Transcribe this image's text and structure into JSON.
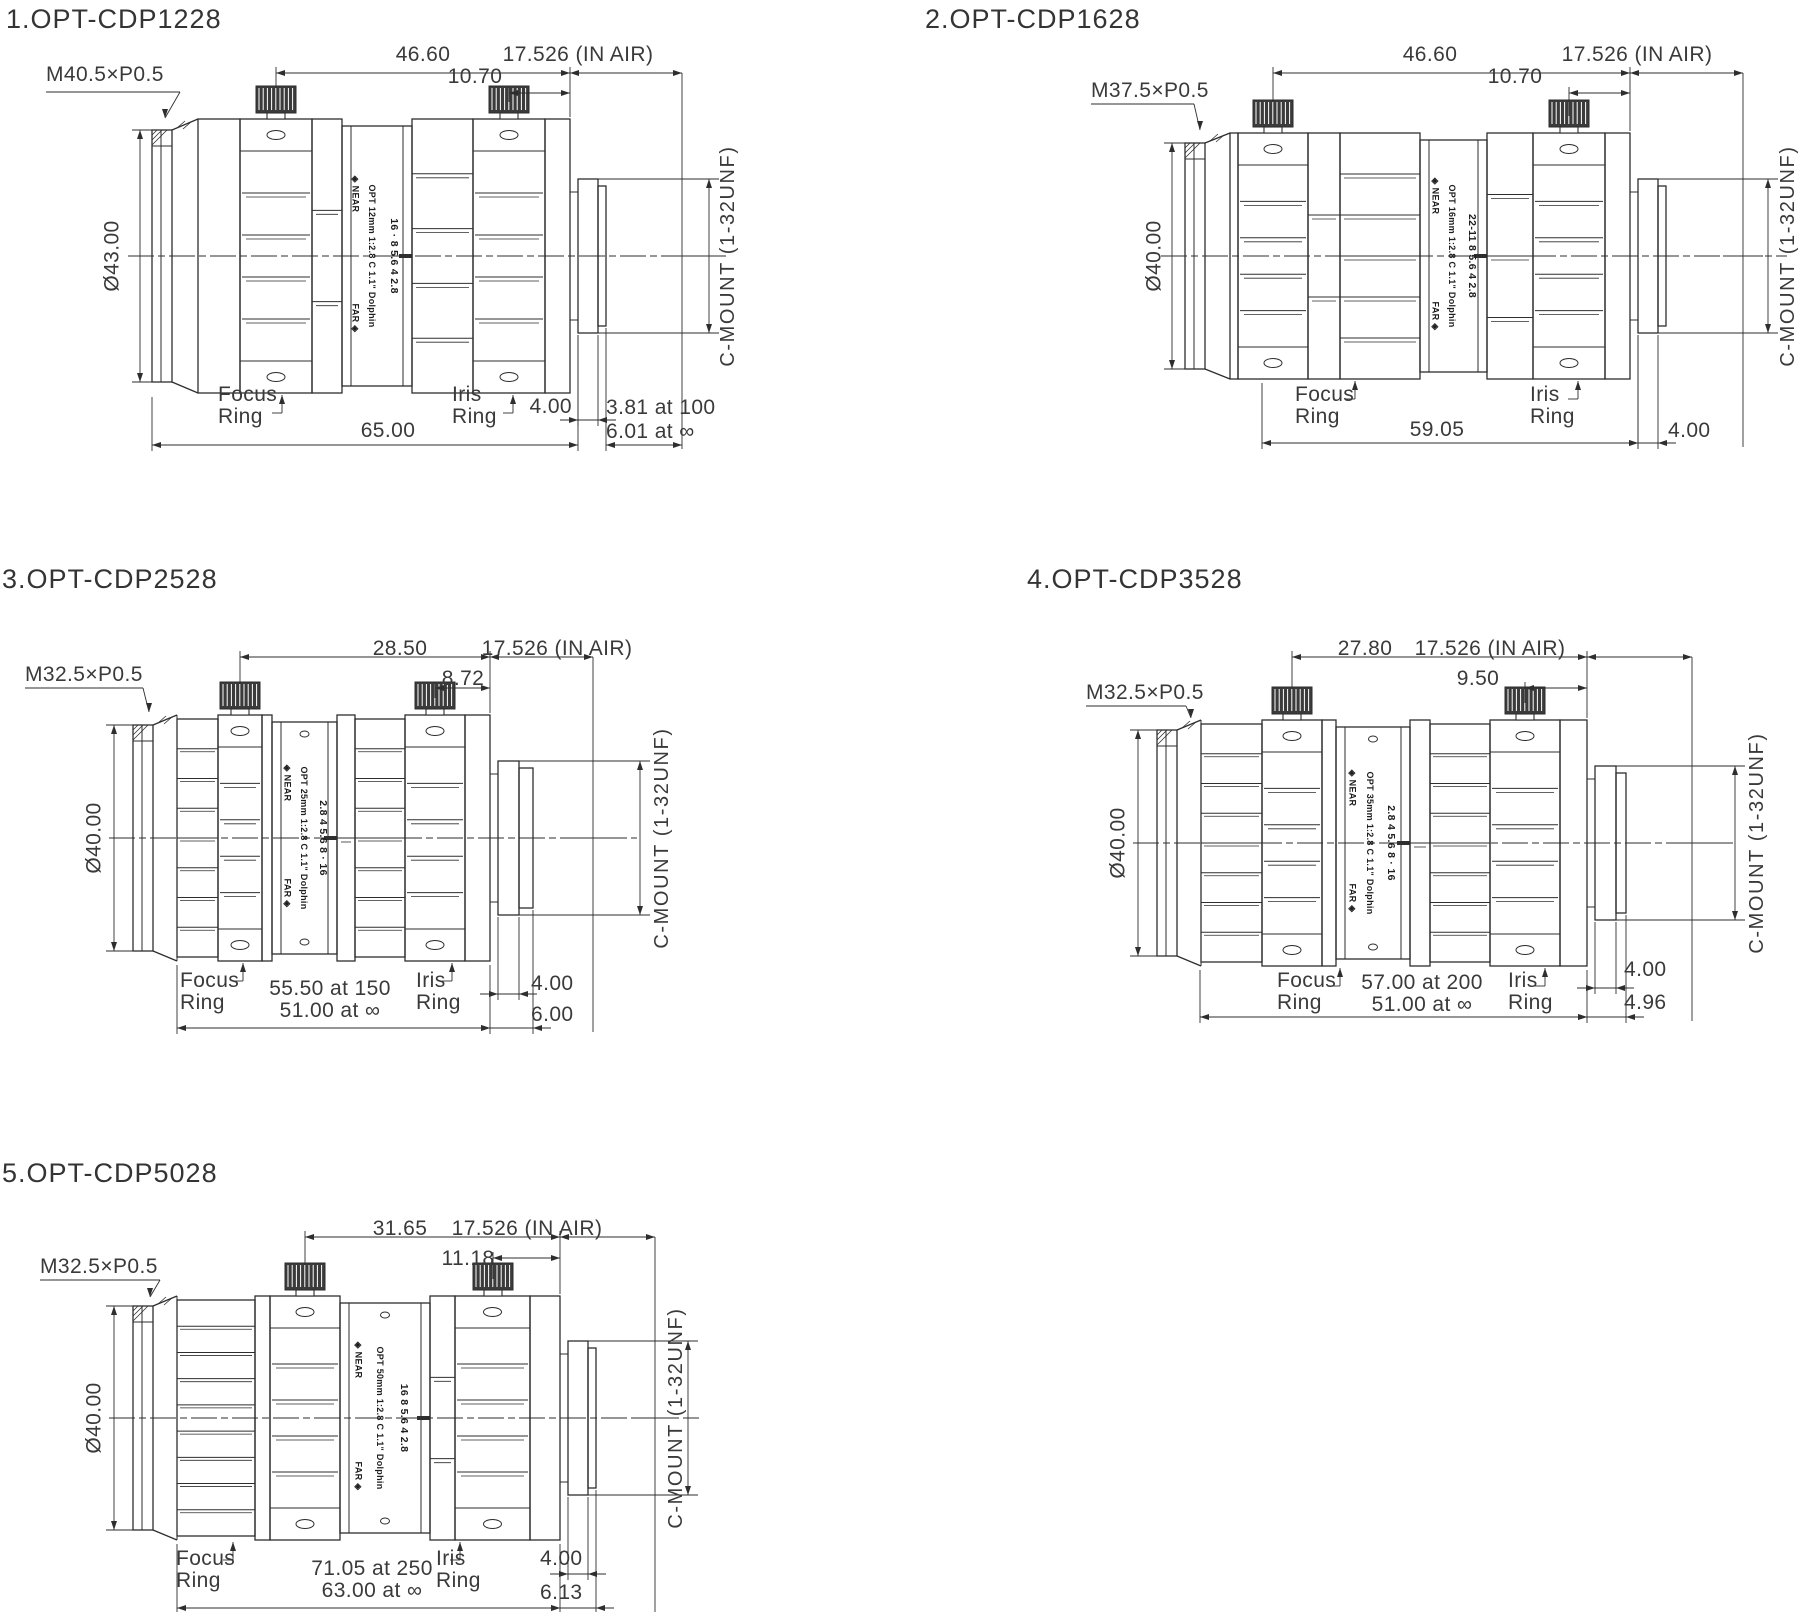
{
  "canvas": {
    "background": "#ffffff",
    "line_color": "#2e2e2e",
    "text_color": "#3a3a3a"
  },
  "drawings": [
    {
      "title": "1.OPT-CDP1228",
      "thread": "M40.5×P0.5",
      "diameter": "Ø43.00",
      "dim_span_focus": "46.60",
      "dim_air": "17.526 (IN AIR)",
      "dim_span_iris": "10.70",
      "focus_label": [
        "Focus",
        "Ring"
      ],
      "iris_label": [
        "Iris",
        "Ring"
      ],
      "mount_label": "C-MOUNT  (1-32UNF)",
      "dim_flange": "4.00",
      "dim_length": [
        "65.00"
      ],
      "dim_rear": [
        "3.81 at 100",
        "6.01 at ∞"
      ],
      "print_near": "◈ NEAR",
      "print_far": "FAR ◈",
      "print_model": "OPT 12mm 1:2.8 C 1.1\" Dolphin",
      "print_aperture": "16 · 8 5.6 4 2.8"
    },
    {
      "title": "2.OPT-CDP1628",
      "thread": "M37.5×P0.5",
      "diameter": "Ø40.00",
      "dim_span_focus": "46.60",
      "dim_air": "17.526 (IN AIR)",
      "dim_span_iris": "10.70",
      "focus_label": [
        "Focus",
        "Ring"
      ],
      "iris_label": [
        "Iris",
        "Ring"
      ],
      "mount_label": "C-MOUNT  (1-32UNF)",
      "dim_flange": "4.00",
      "dim_length": [
        "59.05"
      ],
      "dim_rear": [],
      "print_near": "◈ NEAR",
      "print_far": "FAR ◈",
      "print_model": "OPT 16mm 1:2.8 C 1.1\" Dolphin",
      "print_aperture": "22-11 8 5.6 4 2.8"
    },
    {
      "title": "3.OPT-CDP2528",
      "thread": "M32.5×P0.5",
      "diameter": "Ø40.00",
      "dim_span_focus": "28.50",
      "dim_air": "17.526 (IN AIR)",
      "dim_span_iris": "8.72",
      "focus_label": [
        "Focus",
        "Ring"
      ],
      "iris_label": [
        "Iris",
        "Ring"
      ],
      "mount_label": "C-MOUNT  (1-32UNF)",
      "dim_flange": "4.00",
      "dim_length": [
        "55.50 at 150",
        "51.00 at ∞"
      ],
      "dim_rear": [
        "6.00"
      ],
      "print_near": "◈ NEAR",
      "print_far": "FAR ◈",
      "print_model": "OPT 25mm 1:2.8 C 1.1\" Dolphin",
      "print_aperture": "2.8 4 5.6 8 · 16"
    },
    {
      "title": "4.OPT-CDP3528",
      "thread": "M32.5×P0.5",
      "diameter": "Ø40.00",
      "dim_span_focus": "27.80",
      "dim_air": "17.526 (IN AIR)",
      "dim_span_iris": "9.50",
      "focus_label": [
        "Focus",
        "Ring"
      ],
      "iris_label": [
        "Iris",
        "Ring"
      ],
      "mount_label": "C-MOUNT  (1-32UNF)",
      "dim_flange": "4.00",
      "dim_length": [
        "57.00 at 200",
        "51.00 at ∞"
      ],
      "dim_rear": [
        "4.96"
      ],
      "print_near": "◈ NEAR",
      "print_far": "FAR ◈",
      "print_model": "OPT 35mm 1:2.8 C 1.1\" Dolphin",
      "print_aperture": "2.8 4 5.6 8 · 16"
    },
    {
      "title": "5.OPT-CDP5028",
      "thread": "M32.5×P0.5",
      "diameter": "Ø40.00",
      "dim_span_focus": "31.65",
      "dim_air": "17.526 (IN AIR)",
      "dim_span_iris": "11.18",
      "focus_label": [
        "Focus",
        "Ring"
      ],
      "iris_label": [
        "Iris",
        "Ring"
      ],
      "mount_label": "C-MOUNT  (1-32UNF)",
      "dim_flange": "4.00",
      "dim_length": [
        "71.05 at 250",
        "63.00 at ∞"
      ],
      "dim_rear": [
        "6.13"
      ],
      "print_near": "◈ NEAR",
      "print_far": "FAR ◈",
      "print_model": "OPT 50mm 1:2.8 C 1.1\" Dolphin",
      "print_aperture": "16 8 5.6 4 2.8"
    }
  ]
}
